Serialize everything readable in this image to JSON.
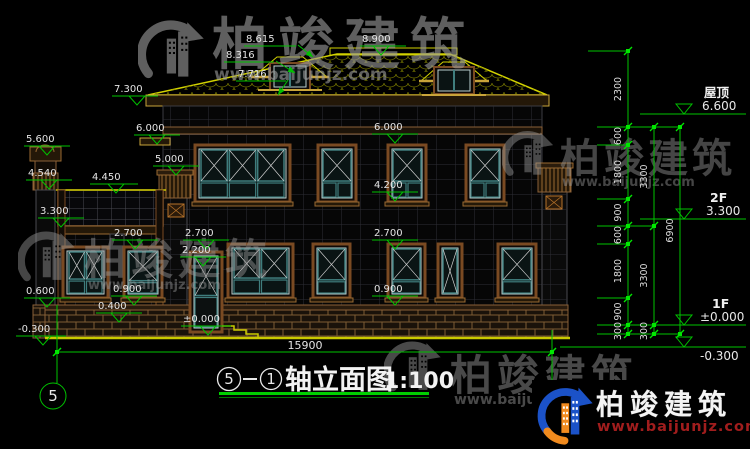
{
  "drawing": {
    "title": {
      "axis_from": "5",
      "axis_to": "1",
      "name": "轴立面图",
      "scale": "1:100"
    },
    "grid_bubbles": {
      "left": "5",
      "right": ""
    },
    "overall_width_dim": "15900",
    "elevation_marks": [
      {
        "id": "dormer_top",
        "text": "8.615"
      },
      {
        "id": "dormer_eave",
        "text": "8.316"
      },
      {
        "id": "dormer_sill",
        "text": "7.716"
      },
      {
        "id": "ridge",
        "text": "8.900"
      },
      {
        "id": "main_eave",
        "text": "7.300"
      },
      {
        "id": "band_left",
        "text": "6.000"
      },
      {
        "id": "gate_pillar_top",
        "text": "5.600"
      },
      {
        "id": "pilaster_cap",
        "text": "5.000"
      },
      {
        "id": "gate_pillar_tier",
        "text": "4.540"
      },
      {
        "id": "trellis_top",
        "text": "4.450"
      },
      {
        "id": "porch_beam",
        "text": "3.300"
      },
      {
        "id": "head_1f_left",
        "text": "2.700"
      },
      {
        "id": "head_1f_mid",
        "text": "2.700"
      },
      {
        "id": "door_transom",
        "text": "2.200"
      },
      {
        "id": "band_mid",
        "text": "6.000"
      },
      {
        "id": "sill_2f",
        "text": "4.200"
      },
      {
        "id": "head_1f_right",
        "text": "2.700"
      },
      {
        "id": "sill_1f_right",
        "text": "0.900"
      },
      {
        "id": "sill_1f_left",
        "text": "0.900"
      },
      {
        "id": "plinth_left",
        "text": "0.600"
      },
      {
        "id": "plinth_top",
        "text": "0.400"
      },
      {
        "id": "floor_level",
        "text": "±0.000"
      },
      {
        "id": "ground_left",
        "text": "-0.300"
      }
    ],
    "right_levels": [
      {
        "label": "屋顶",
        "value": "6.600"
      },
      {
        "label": "2F",
        "value": "3.300"
      },
      {
        "label": "1F",
        "value": "±0.000"
      },
      {
        "label": "",
        "value": "-0.300"
      }
    ],
    "dim_chains": [
      {
        "segments": [
          "2300",
          "600",
          "1800",
          "900",
          "600",
          "1800",
          "900",
          "300"
        ]
      },
      {
        "segments": [
          "3300",
          "3300",
          "300"
        ]
      },
      {
        "segments": [
          "6900"
        ]
      }
    ]
  },
  "watermark": {
    "brand": "柏竣建筑",
    "url": "www.baijunjz.com"
  },
  "colors": {
    "dim_green": "#00c300",
    "cad_yellow": "#d2d200",
    "frame_brown": "#8a6038",
    "glass_teal": "#3f7d7d",
    "logo_blue": "#1b52c8",
    "logo_orange": "#f08a1e",
    "watermark_gray": "#9a9a9a",
    "url_red": "#a11d1d"
  }
}
